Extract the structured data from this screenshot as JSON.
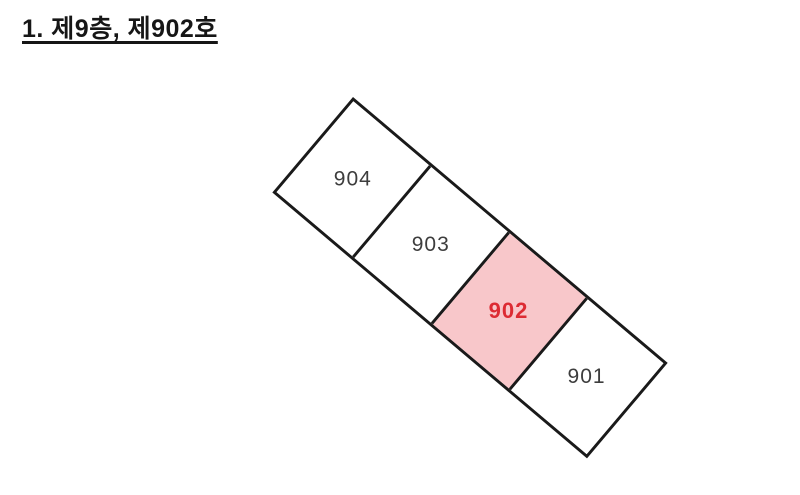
{
  "title": "1. 제9층, 제902호",
  "diagram": {
    "description": "floor-plan-strip-of-four-units",
    "highlighted_unit": "902",
    "units": [
      {
        "label": "904",
        "highlighted": false
      },
      {
        "label": "903",
        "highlighted": false
      },
      {
        "label": "902",
        "highlighted": true
      },
      {
        "label": "901",
        "highlighted": false
      }
    ],
    "colors": {
      "outline": "#1a1a1a",
      "unit_fill": "#ffffff",
      "highlight_fill": "#f8c7ca",
      "highlight_text": "#dd2b33",
      "label_text": "#3d3d3d"
    }
  }
}
